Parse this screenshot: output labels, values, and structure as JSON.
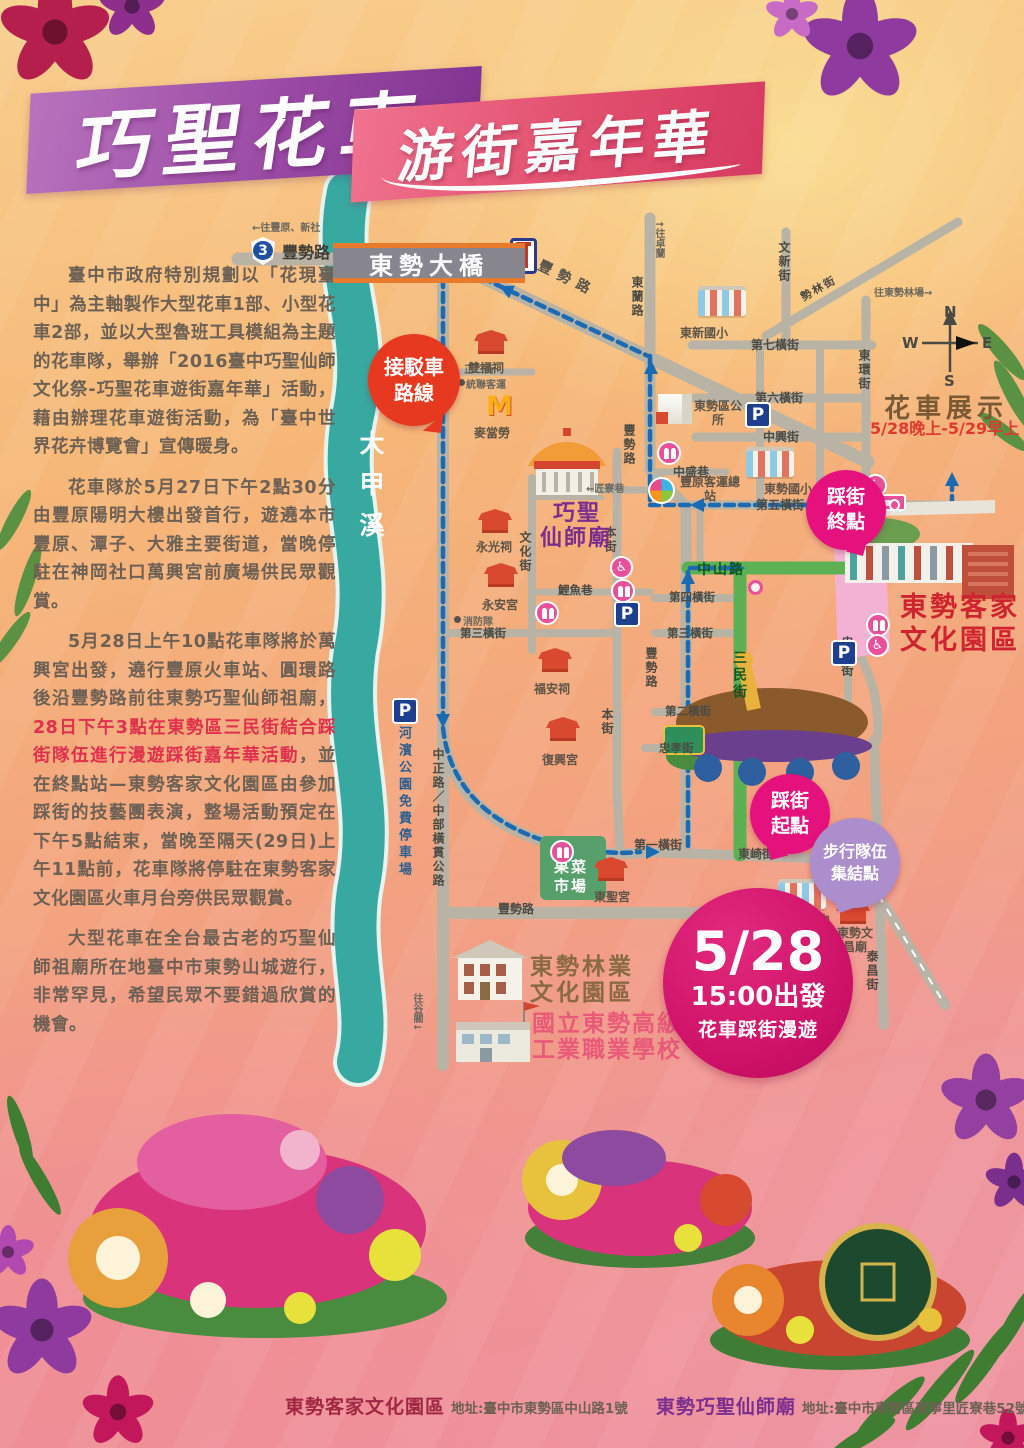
{
  "title": {
    "main": "巧聖花車",
    "sub": "游街嘉年華"
  },
  "intro": {
    "p1": "臺中市政府特別規劃以「花現臺中」為主軸製作大型花車1部、小型花車2部，並以大型魯班工具模組為主題的花車隊，舉辦「2016臺中巧聖仙師文化祭-巧聖花車遊街嘉年華」活動，藉由辦理花車遊街活動，為「臺中世界花卉博覽會」宣傳暖身。",
    "p2": "花車隊於5月27日下午2點30分由豐原陽明大樓出發首行，遊遶本市豐原、潭子、大雅主要街道，當晚停駐在神岡社口萬興宮前廣場供民眾觀賞。",
    "p3_before": "5月28日上午10點花車隊將於萬興宮出發，遶行豐原火車站、圓環路後沿豐勢路前往東勢巧聖仙師祖廟，",
    "p3_red": "28日下午3點在東勢區三民街結合踩街隊伍進行漫遊踩街嘉年華活動",
    "p3_after": "，並在終點站—東勢客家文化園區由參加踩街的技藝團表演，整場活動預定在下午5點結束，當晚至隔天(29日)上午11點前，花車隊將停駐在東勢客家文化園區火車月台旁供民眾觀賞。",
    "p4": "大型花車在全台最古老的巧聖仙師祖廟所在地臺中市東勢山城遊行，非常罕見，希望民眾不要錯過欣賞的機會。"
  },
  "map": {
    "bridge": "東勢大橋",
    "highway": {
      "no": "3",
      "road": "豐勢路"
    },
    "river": "大甲溪",
    "bubbles": {
      "shuttle1": "接駁車",
      "shuttle2": "路線",
      "end1": "踩街",
      "end2": "終點",
      "start1": "踩街",
      "start2": "起點",
      "walk1": "步行隊伍",
      "walk2": "集結點"
    },
    "event": {
      "date": "5/28",
      "time": "15:00出發",
      "desc": "花車踩街漫遊"
    },
    "labels": [
      {
        "t": "←往豐原、新社",
        "x": 252,
        "y": 219,
        "c": "tiny"
      },
      {
        "t": "↑往卓蘭",
        "x": 651,
        "y": 220,
        "c": "tiny-v"
      },
      {
        "t": "往東勢林場→",
        "x": 874,
        "y": 284,
        "c": "tiny"
      },
      {
        "t": "往谷關↓",
        "x": 409,
        "y": 993,
        "c": "tiny-v"
      },
      {
        "t": "東蘭路",
        "x": 629,
        "y": 276,
        "c": "st-v"
      },
      {
        "t": "豐勢路",
        "x": 536,
        "y": 268,
        "c": "st-diag"
      },
      {
        "t": "文新街",
        "x": 776,
        "y": 241,
        "c": "st-v"
      },
      {
        "t": "勢林街",
        "x": 799,
        "y": 280,
        "c": "st-diag2"
      },
      {
        "t": "第七橫街",
        "x": 751,
        "y": 336,
        "c": "st"
      },
      {
        "t": "東環街",
        "x": 856,
        "y": 349,
        "c": "st-v"
      },
      {
        "t": "第六橫街",
        "x": 755,
        "y": 389,
        "c": "st"
      },
      {
        "t": "中興街",
        "x": 763,
        "y": 428,
        "c": "st"
      },
      {
        "t": "中盛巷",
        "x": 673,
        "y": 463,
        "c": "st"
      },
      {
        "t": "第五橫街",
        "x": 756,
        "y": 496,
        "c": "st"
      },
      {
        "t": "中山路",
        "x": 697,
        "y": 559,
        "c": "st-green"
      },
      {
        "t": "三民街",
        "x": 729,
        "y": 650,
        "c": "st-green-v"
      },
      {
        "t": "第四橫街",
        "x": 669,
        "y": 589,
        "c": "st-sm"
      },
      {
        "t": "第三橫街",
        "x": 667,
        "y": 625,
        "c": "st-sm"
      },
      {
        "t": "忠孝街",
        "x": 839,
        "y": 636,
        "c": "st-v"
      },
      {
        "t": "第二橫街",
        "x": 665,
        "y": 703,
        "c": "st-sm"
      },
      {
        "t": "忠孝街",
        "x": 659,
        "y": 740,
        "c": "st-sm"
      },
      {
        "t": "本街",
        "x": 602,
        "y": 526,
        "c": "st-v"
      },
      {
        "t": "本街",
        "x": 599,
        "y": 708,
        "c": "st-v"
      },
      {
        "t": "文化街",
        "x": 517,
        "y": 531,
        "c": "st-v"
      },
      {
        "t": "鯉魚巷",
        "x": 558,
        "y": 582,
        "c": "st-sm"
      },
      {
        "t": "第三橫街",
        "x": 460,
        "y": 625,
        "c": "st-sm"
      },
      {
        "t": "←匠寮巷",
        "x": 586,
        "y": 480,
        "c": "tiny"
      },
      {
        "t": "正二街",
        "x": 464,
        "y": 361,
        "c": "tiny"
      },
      {
        "t": "統聯客運",
        "x": 466,
        "y": 376,
        "c": "tiny"
      },
      {
        "t": "消防隊",
        "x": 463,
        "y": 613,
        "c": "tiny"
      },
      {
        "t": "豐勢路",
        "x": 621,
        "y": 424,
        "c": "st-v"
      },
      {
        "t": "豐勢路",
        "x": 643,
        "y": 647,
        "c": "st-v"
      },
      {
        "t": "中正路／中部橫貫公路",
        "x": 430,
        "y": 748,
        "c": "st-v"
      },
      {
        "t": "河濱公園免費停車場",
        "x": 394,
        "y": 726,
        "c": "blue-v"
      },
      {
        "t": "豐勢路",
        "x": 498,
        "y": 900,
        "c": "st"
      },
      {
        "t": "第一橫街",
        "x": 634,
        "y": 836,
        "c": "st"
      },
      {
        "t": "東崎街",
        "x": 738,
        "y": 845,
        "c": "st"
      },
      {
        "t": "泰昌街",
        "x": 864,
        "y": 950,
        "c": "st-v"
      },
      {
        "t": "雙福祠",
        "x": 468,
        "y": 359,
        "c": "pl"
      },
      {
        "t": "麥當勞",
        "x": 474,
        "y": 424,
        "c": "pl"
      },
      {
        "t": "永光祠",
        "x": 476,
        "y": 538,
        "c": "pl"
      },
      {
        "t": "永安宮",
        "x": 482,
        "y": 596,
        "c": "pl"
      },
      {
        "t": "福安祠",
        "x": 534,
        "y": 680,
        "c": "pl"
      },
      {
        "t": "復興宮",
        "x": 542,
        "y": 751,
        "c": "pl"
      },
      {
        "t": "東聖宮",
        "x": 594,
        "y": 888,
        "c": "pl"
      },
      {
        "t": "東新國小",
        "x": 680,
        "y": 324,
        "c": "pl"
      },
      {
        "t": "東勢區公所",
        "x": 692,
        "y": 400,
        "c": "pl2",
        "w": 52
      },
      {
        "t": "豐原客運總站",
        "x": 678,
        "y": 476,
        "c": "pl2",
        "w": 64
      },
      {
        "t": "東勢國小",
        "x": 764,
        "y": 480,
        "c": "pl"
      },
      {
        "t": "東勢國中",
        "x": 782,
        "y": 911,
        "c": "pl"
      },
      {
        "t": "東勢文昌廟",
        "x": 832,
        "y": 927,
        "c": "pl2",
        "w": 46
      },
      {
        "t": "果菜市場",
        "x": 551,
        "y": 858,
        "c": "market",
        "w": 40
      },
      {
        "t": "巧聖",
        "x": 553,
        "y": 495,
        "c": "temple-big"
      },
      {
        "t": "仙師廟",
        "x": 540,
        "y": 520,
        "c": "temple-big"
      },
      {
        "t": "東勢客家",
        "x": 900,
        "y": 585,
        "c": "park-red"
      },
      {
        "t": "文化園區",
        "x": 900,
        "y": 618,
        "c": "park-red"
      },
      {
        "t": "東勢林業",
        "x": 530,
        "y": 947,
        "c": "forest"
      },
      {
        "t": "文化園區",
        "x": 530,
        "y": 973,
        "c": "forest"
      },
      {
        "t": "國立東勢高級",
        "x": 532,
        "y": 1004,
        "c": "school-pink"
      },
      {
        "t": "工業職業學校",
        "x": 532,
        "y": 1030,
        "c": "school-pink"
      },
      {
        "t": "花車展示",
        "x": 884,
        "y": 388,
        "c": "display-t"
      },
      {
        "t": "5/28晚上-5/29早上",
        "x": 870,
        "y": 415,
        "c": "display-time"
      },
      {
        "t": "N",
        "x": 944,
        "y": 303,
        "c": "compass"
      },
      {
        "t": "W",
        "x": 902,
        "y": 334,
        "c": "compass"
      },
      {
        "t": "E",
        "x": 982,
        "y": 334,
        "c": "compass"
      },
      {
        "t": "S",
        "x": 944,
        "y": 372,
        "c": "compass"
      }
    ],
    "icons": [
      {
        "k": "temple",
        "x": 474,
        "y": 330
      },
      {
        "k": "temple",
        "x": 478,
        "y": 509
      },
      {
        "k": "temple",
        "x": 484,
        "y": 563
      },
      {
        "k": "temple",
        "x": 538,
        "y": 648
      },
      {
        "k": "temple",
        "x": 546,
        "y": 717
      },
      {
        "k": "temple",
        "x": 594,
        "y": 857
      },
      {
        "k": "temple",
        "x": 836,
        "y": 900
      },
      {
        "k": "mc",
        "x": 486,
        "y": 394,
        "t": "M"
      },
      {
        "k": "parking",
        "x": 745,
        "y": 402,
        "t": "P"
      },
      {
        "k": "parking",
        "x": 392,
        "y": 698,
        "t": "P"
      },
      {
        "k": "parking",
        "x": 614,
        "y": 601,
        "t": "P"
      },
      {
        "k": "parking",
        "x": 831,
        "y": 640,
        "t": "P"
      },
      {
        "k": "restroom",
        "x": 657,
        "y": 441
      },
      {
        "k": "restroom",
        "x": 535,
        "y": 601
      },
      {
        "k": "restroom",
        "x": 611,
        "y": 579
      },
      {
        "k": "restroom",
        "x": 866,
        "y": 613
      },
      {
        "k": "restroom",
        "x": 550,
        "y": 840
      },
      {
        "k": "wheel",
        "x": 610,
        "y": 556
      },
      {
        "k": "wheel",
        "x": 866,
        "y": 634
      },
      {
        "k": "wheel",
        "x": 864,
        "y": 474
      },
      {
        "k": "sign",
        "x": 858,
        "y": 494
      },
      {
        "k": "shrine",
        "x": 510,
        "y": 238
      },
      {
        "k": "dot",
        "x": 458,
        "y": 379
      },
      {
        "k": "dot",
        "x": 454,
        "y": 616
      },
      {
        "k": "school",
        "x": 698,
        "y": 290
      },
      {
        "k": "school",
        "x": 746,
        "y": 451
      },
      {
        "k": "school",
        "x": 778,
        "y": 883
      },
      {
        "k": "office",
        "x": 658,
        "y": 394
      },
      {
        "k": "pinwheel",
        "x": 648,
        "y": 477
      },
      {
        "k": "marker",
        "x": 748,
        "y": 580
      }
    ]
  },
  "footer": {
    "venue1": {
      "name": "東勢客家文化園區",
      "addr": "地址:臺中市東勢區中山路1號"
    },
    "venue2": {
      "name": "東勢巧聖仙師廟",
      "addr": "地址:臺中市東勢區東寧里匠寮巷52號"
    }
  }
}
